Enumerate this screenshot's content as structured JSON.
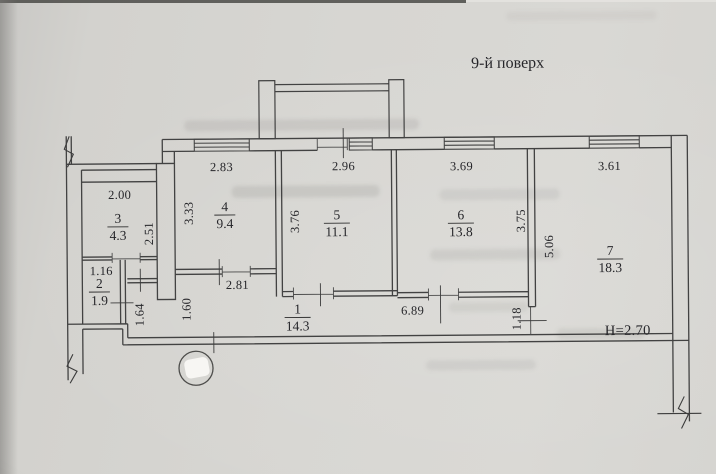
{
  "plan": {
    "floor_label": "9-й поверх",
    "ceiling_height_label": "Н=2.70",
    "rooms": [
      {
        "number": "1",
        "area": "14.3",
        "cx": 297,
        "cy": 309
      },
      {
        "number": "2",
        "area": "1.9",
        "cx": 99,
        "cy": 282
      },
      {
        "number": "3",
        "area": "4.3",
        "cx": 118,
        "cy": 217
      },
      {
        "number": "4",
        "area": "9.4",
        "cx": 225,
        "cy": 206
      },
      {
        "number": "5",
        "area": "11.1",
        "cx": 337,
        "cy": 215
      },
      {
        "number": "6",
        "area": "13.8",
        "cx": 461,
        "cy": 216
      },
      {
        "number": "7",
        "area": "18.3",
        "cx": 610,
        "cy": 253
      }
    ],
    "dimensions": [
      {
        "text": "2.83",
        "x": 222,
        "y": 166,
        "rot": 0
      },
      {
        "text": "2.96",
        "x": 344,
        "y": 166,
        "rot": 0
      },
      {
        "text": "3.69",
        "x": 462,
        "y": 167,
        "rot": 0
      },
      {
        "text": "3.61",
        "x": 610,
        "y": 168,
        "rot": 0
      },
      {
        "text": "2.00",
        "x": 120,
        "y": 193,
        "rot": 0
      },
      {
        "text": "3.33",
        "x": 189,
        "y": 212,
        "rot": -90
      },
      {
        "text": "2.51",
        "x": 149,
        "y": 232,
        "rot": -90
      },
      {
        "text": "3.76",
        "x": 295,
        "y": 221,
        "rot": -90
      },
      {
        "text": "3.75",
        "x": 521,
        "y": 222,
        "rot": -90
      },
      {
        "text": "5.06",
        "x": 549,
        "y": 248,
        "rot": -90
      },
      {
        "text": "1.16",
        "x": 101,
        "y": 269,
        "rot": 0
      },
      {
        "text": "2.81",
        "x": 237,
        "y": 284,
        "rot": 0
      },
      {
        "text": "1.64",
        "x": 139,
        "y": 313,
        "rot": -90
      },
      {
        "text": "1.60",
        "x": 186,
        "y": 308,
        "rot": -90
      },
      {
        "text": "6.89",
        "x": 412,
        "y": 311,
        "rot": 0
      },
      {
        "text": "1.18",
        "x": 516,
        "y": 320,
        "rot": -90
      },
      {
        "text": "Н=2.70",
        "x": 627,
        "y": 333,
        "rot": 0,
        "size": 14.5
      }
    ]
  }
}
